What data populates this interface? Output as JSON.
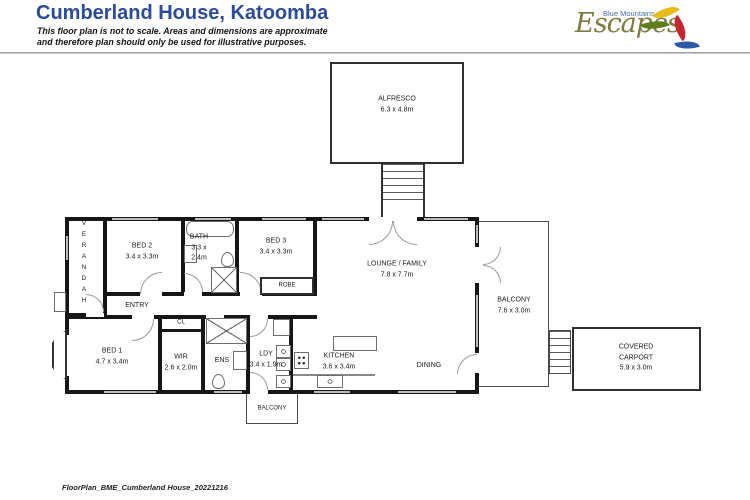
{
  "page": {
    "title": "Cumberland House, Katoomba",
    "disclaimer1": "This floor plan is not to scale.  Areas and dimensions are approximate",
    "disclaimer2": "and therefore plan should only be used for illustrative purposes.",
    "footer": "FloorPlan_BME_Cumberland House_20221216",
    "accent_blue": "#2b4b9b"
  },
  "logo": {
    "tagline": "Blue Mountains",
    "name": "Escapes",
    "colors": {
      "script": "#7c7a3e",
      "tagline": "#4a6fa8",
      "leaf_yellow": "#e7bb18",
      "leaf_green": "#5e7d1f",
      "leaf_red": "#c42531",
      "leaf_blue": "#2d59a8"
    }
  },
  "rooms": {
    "alfresco": {
      "name": "ALFRESCO",
      "dims": "6.3 x 4.8m"
    },
    "verandah": {
      "name": "VERANDAH"
    },
    "bed2": {
      "name": "BED 2",
      "dims": "3.4 x 3.3m"
    },
    "bath": {
      "name": "BATH",
      "dims_a": "3.3 x",
      "dims_b": "2.4m"
    },
    "bed3": {
      "name": "BED 3",
      "dims": "3.4 x 3.3m"
    },
    "robe": {
      "name": "ROBE"
    },
    "lounge": {
      "name": "LOUNGE / FAMILY",
      "dims": "7.8 x 7.7m"
    },
    "entry": {
      "name": "ENTRY"
    },
    "bed1": {
      "name": "BED 1",
      "dims": "4.7 x 3.4m"
    },
    "cl": {
      "name": "CL"
    },
    "wir": {
      "name": "WIR",
      "dims": "2.6 x 2.0m"
    },
    "ens": {
      "name": "ENS"
    },
    "ldy": {
      "name": "LDY",
      "dims": "3.4 x 1.9m"
    },
    "kitchen": {
      "name": "KITCHEN",
      "dims": "3.6 x 3.4m"
    },
    "dining": {
      "name": "DINING"
    },
    "balcony_right": {
      "name": "BALCONY",
      "dims": "7.6 x 3.0m"
    },
    "balcony_bottom": {
      "name": "BALCONY"
    },
    "carport": {
      "name1": "COVERED",
      "name2": "CARPORT",
      "dims": "5.9 x 3.0m"
    }
  }
}
